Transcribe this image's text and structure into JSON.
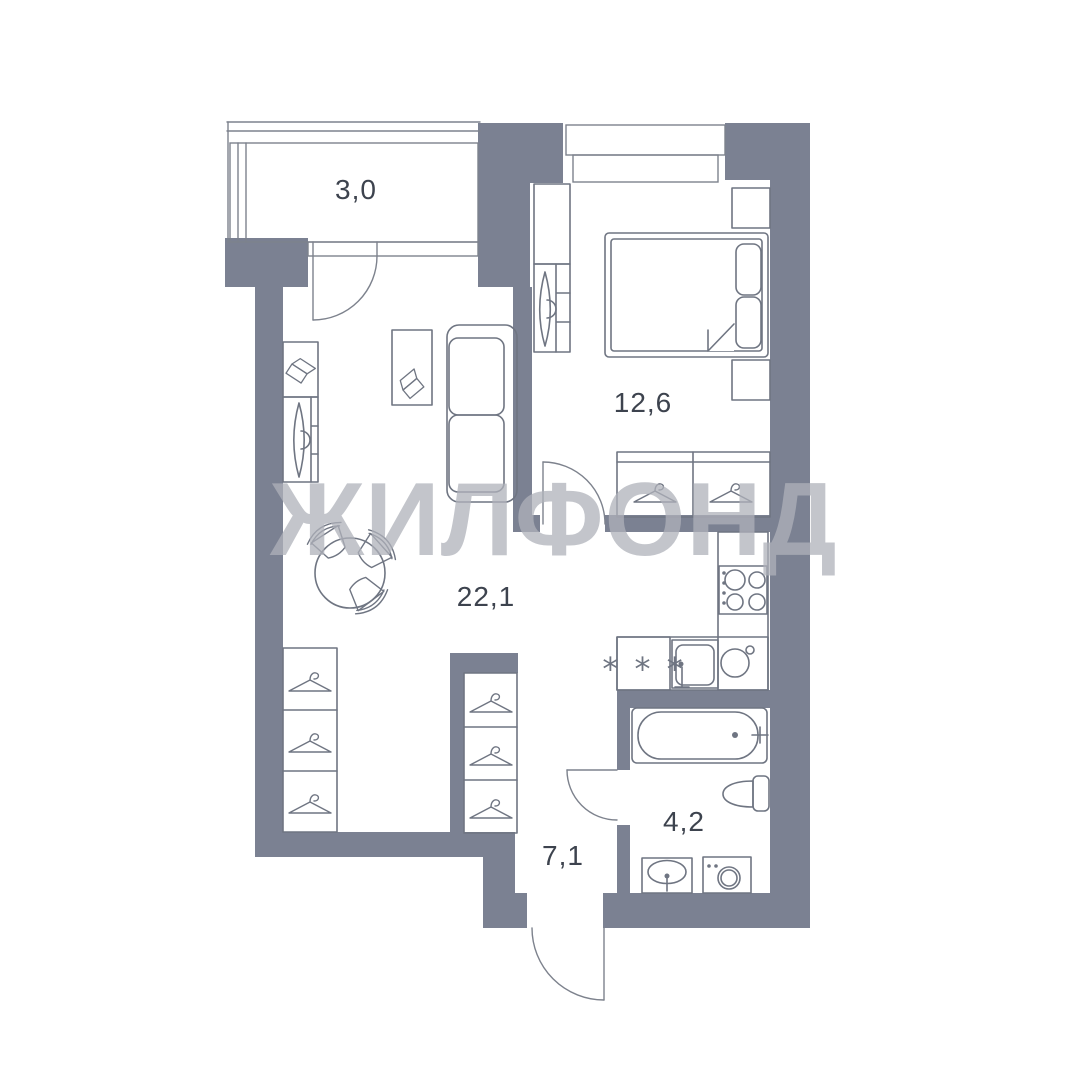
{
  "watermark": "ЖИЛФОНД",
  "rooms": {
    "balcony": {
      "area": "3,0"
    },
    "bedroom": {
      "area": "12,6"
    },
    "living_kitchen": {
      "area": "22,1"
    },
    "hallway": {
      "area": "7,1"
    },
    "bathroom": {
      "area": "4,2"
    }
  },
  "symbols": {
    "fridge": "* * *"
  },
  "colors": {
    "wall": "#7b8192",
    "furniture_line": "#6f7582",
    "label_text": "#3d434e",
    "watermark": "#afb2ba",
    "background": "#ffffff"
  }
}
